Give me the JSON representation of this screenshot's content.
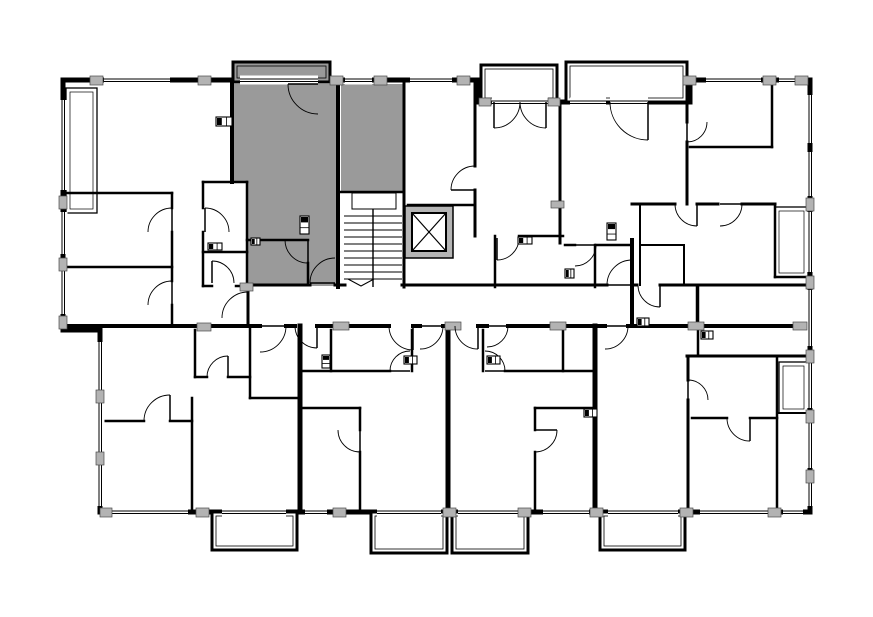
{
  "meta": {
    "title": "apartment-building-floor-plan",
    "canvas": {
      "w": 873,
      "h": 617
    }
  },
  "colors": {
    "bg": "#ffffff",
    "wall": "#000000",
    "highlight": "#9a9a9a",
    "pier": "#b3b3b3",
    "pier_edge": "#4a4a4a",
    "elevator_wall": "#b5b5b5",
    "thin_line": "#000000"
  },
  "plan": {
    "outline": [
      [
        63,
        80
      ],
      [
        477,
        80
      ],
      [
        477,
        102
      ],
      [
        690,
        102
      ],
      [
        690,
        80
      ],
      [
        810,
        80
      ],
      [
        810,
        512
      ],
      [
        100,
        512
      ],
      [
        100,
        330
      ],
      [
        63,
        330
      ]
    ],
    "balconies": [
      {
        "x": 233,
        "y": 62,
        "w": 97,
        "h": 20,
        "fill": "highlight"
      },
      {
        "x": 481,
        "y": 65,
        "w": 76,
        "h": 37,
        "fill": "bg"
      },
      {
        "x": 566,
        "y": 62,
        "w": 121,
        "h": 40,
        "fill": "bg"
      },
      {
        "x": 212,
        "y": 512,
        "w": 85,
        "h": 38,
        "fill": "bg"
      },
      {
        "x": 371,
        "y": 512,
        "w": 76,
        "h": 41,
        "fill": "bg"
      },
      {
        "x": 452,
        "y": 512,
        "w": 76,
        "h": 41,
        "fill": "bg"
      },
      {
        "x": 600,
        "y": 512,
        "w": 85,
        "h": 38,
        "fill": "bg"
      }
    ],
    "highlight_polys": [
      [
        [
          232,
          84
        ],
        [
          338,
          84
        ],
        [
          338,
          286
        ],
        [
          247,
          286
        ],
        [
          247,
          182
        ],
        [
          232,
          182
        ]
      ],
      [
        [
          341,
          84
        ],
        [
          403,
          84
        ],
        [
          403,
          192
        ],
        [
          341,
          192
        ]
      ]
    ],
    "thin_rooms": [
      {
        "x": 66,
        "y": 88,
        "w": 31,
        "h": 125
      },
      {
        "x": 775,
        "y": 207,
        "w": 33,
        "h": 70
      },
      {
        "x": 779,
        "y": 362,
        "w": 29,
        "h": 51
      }
    ],
    "walls": [
      [
        232,
        84,
        232,
        182,
        4
      ],
      [
        338,
        84,
        338,
        287,
        4
      ],
      [
        404,
        84,
        404,
        287,
        3
      ],
      [
        475,
        80,
        475,
        166,
        3
      ],
      [
        475,
        190,
        475,
        236,
        3
      ],
      [
        560,
        102,
        560,
        243,
        3
      ],
      [
        632,
        240,
        632,
        326,
        4
      ],
      [
        687,
        80,
        687,
        122,
        3
      ],
      [
        687,
        142,
        687,
        204,
        3
      ],
      [
        772,
        80,
        772,
        147,
        2.5
      ],
      [
        248,
        285,
        310,
        285,
        3
      ],
      [
        335,
        285,
        345,
        285,
        3
      ],
      [
        402,
        285,
        607,
        285,
        3
      ],
      [
        632,
        285,
        637,
        285,
        3
      ],
      [
        660,
        285,
        810,
        285,
        3
      ],
      [
        248,
        285,
        248,
        326,
        3
      ],
      [
        63,
        326,
        260,
        326,
        4
      ],
      [
        286,
        326,
        295,
        326,
        4
      ],
      [
        317,
        326,
        389,
        326,
        4
      ],
      [
        413,
        326,
        420,
        326,
        4
      ],
      [
        443,
        326,
        455,
        326,
        4
      ],
      [
        478,
        326,
        487,
        326,
        4
      ],
      [
        508,
        326,
        605,
        326,
        4
      ],
      [
        628,
        326,
        810,
        326,
        4
      ],
      [
        247,
        240,
        308,
        240,
        2.5
      ],
      [
        308,
        263,
        308,
        285,
        2.5
      ],
      [
        341,
        192,
        403,
        192,
        2.5
      ],
      [
        203,
        182,
        247,
        182,
        2.5
      ],
      [
        203,
        182,
        203,
        208,
        2.5
      ],
      [
        203,
        232,
        203,
        286,
        2.5
      ],
      [
        247,
        182,
        247,
        287,
        2.5
      ],
      [
        203,
        252,
        247,
        252,
        2.5
      ],
      [
        203,
        286,
        212,
        286,
        2.5
      ],
      [
        236,
        286,
        247,
        286,
        2.5
      ],
      [
        63,
        193,
        172,
        193,
        2.5
      ],
      [
        172,
        193,
        172,
        208,
        2.5
      ],
      [
        172,
        232,
        172,
        281,
        2.5
      ],
      [
        172,
        305,
        172,
        326,
        2.5
      ],
      [
        63,
        267,
        172,
        267,
        2.5
      ],
      [
        408,
        205,
        475,
        205,
        2.5
      ],
      [
        519,
        236,
        563,
        236,
        2.5
      ],
      [
        495,
        236,
        495,
        287,
        2.5
      ],
      [
        565,
        245,
        575,
        245,
        2.5
      ],
      [
        596,
        245,
        632,
        245,
        2.5
      ],
      [
        595,
        245,
        595,
        287,
        2.5
      ],
      [
        690,
        147,
        772,
        147,
        2.5
      ],
      [
        632,
        204,
        675,
        204,
        3
      ],
      [
        697,
        204,
        718,
        204,
        3
      ],
      [
        742,
        204,
        775,
        204,
        3
      ],
      [
        775,
        204,
        775,
        277,
        2.5
      ],
      [
        775,
        277,
        810,
        277,
        2.5
      ],
      [
        698,
        287,
        698,
        356,
        2.5
      ],
      [
        640,
        204,
        640,
        285,
        2
      ],
      [
        684,
        245,
        684,
        285,
        2
      ],
      [
        640,
        245,
        684,
        245,
        2
      ],
      [
        697,
        287,
        697,
        326,
        2.5
      ],
      [
        687,
        356,
        810,
        356,
        3
      ],
      [
        688,
        356,
        688,
        380,
        3
      ],
      [
        688,
        400,
        688,
        512,
        3
      ],
      [
        692,
        418,
        727,
        418,
        2.5
      ],
      [
        750,
        418,
        777,
        418,
        2.5
      ],
      [
        777,
        356,
        777,
        512,
        2.5
      ],
      [
        777,
        413,
        808,
        413,
        2
      ],
      [
        195,
        330,
        195,
        377,
        2.5
      ],
      [
        195,
        377,
        207,
        377,
        2.5
      ],
      [
        228,
        377,
        250,
        377,
        2.5
      ],
      [
        250,
        326,
        250,
        398,
        2.5
      ],
      [
        250,
        398,
        297,
        398,
        2.5
      ],
      [
        97,
        421,
        144,
        421,
        2.5
      ],
      [
        170,
        421,
        192,
        421,
        2.5
      ],
      [
        192,
        398,
        192,
        512,
        2.5
      ],
      [
        300,
        326,
        300,
        512,
        5
      ],
      [
        448,
        326,
        448,
        512,
        5
      ],
      [
        595,
        326,
        595,
        512,
        5
      ],
      [
        331,
        330,
        331,
        371,
        2.5
      ],
      [
        303,
        371,
        390,
        371,
        2.5
      ],
      [
        412,
        330,
        412,
        371,
        2.5
      ],
      [
        303,
        408,
        360,
        408,
        2.5
      ],
      [
        360,
        408,
        360,
        430,
        2.5
      ],
      [
        360,
        452,
        360,
        512,
        2.5
      ],
      [
        483,
        330,
        483,
        371,
        2.5
      ],
      [
        505,
        371,
        595,
        371,
        2.5
      ],
      [
        563,
        330,
        563,
        371,
        2.5
      ],
      [
        535,
        408,
        595,
        408,
        2.5
      ],
      [
        535,
        408,
        535,
        430,
        2.5
      ],
      [
        535,
        452,
        535,
        512,
        2.5
      ]
    ],
    "windows": [
      {
        "o": "h",
        "x": 104,
        "y": 80,
        "len": 66
      },
      {
        "o": "h",
        "x": 240,
        "y": 80,
        "len": 78
      },
      {
        "o": "h",
        "x": 345,
        "y": 80,
        "len": 27
      },
      {
        "o": "h",
        "x": 410,
        "y": 80,
        "len": 42
      },
      {
        "o": "h",
        "x": 492,
        "y": 102,
        "len": 56
      },
      {
        "o": "h",
        "x": 570,
        "y": 102,
        "len": 36
      },
      {
        "o": "h",
        "x": 610,
        "y": 102,
        "len": 38
      },
      {
        "o": "h",
        "x": 706,
        "y": 80,
        "len": 55
      },
      {
        "o": "h",
        "x": 779,
        "y": 80,
        "len": 16
      },
      {
        "o": "h",
        "x": 112,
        "y": 512,
        "len": 76
      },
      {
        "o": "h",
        "x": 222,
        "y": 512,
        "len": 64
      },
      {
        "o": "h",
        "x": 305,
        "y": 512,
        "len": 22
      },
      {
        "o": "h",
        "x": 377,
        "y": 512,
        "len": 64
      },
      {
        "o": "h",
        "x": 458,
        "y": 512,
        "len": 64
      },
      {
        "o": "h",
        "x": 543,
        "y": 512,
        "len": 46
      },
      {
        "o": "h",
        "x": 608,
        "y": 512,
        "len": 70
      },
      {
        "o": "h",
        "x": 700,
        "y": 512,
        "len": 68
      },
      {
        "o": "h",
        "x": 783,
        "y": 512,
        "len": 20
      },
      {
        "o": "v",
        "x": 63,
        "y": 100,
        "len": 90
      },
      {
        "o": "v",
        "x": 63,
        "y": 212,
        "len": 42
      },
      {
        "o": "v",
        "x": 63,
        "y": 270,
        "len": 44
      },
      {
        "o": "v",
        "x": 100,
        "y": 342,
        "len": 48
      },
      {
        "o": "v",
        "x": 100,
        "y": 402,
        "len": 50
      },
      {
        "o": "v",
        "x": 100,
        "y": 464,
        "len": 42
      },
      {
        "o": "v",
        "x": 810,
        "y": 95,
        "len": 48
      },
      {
        "o": "v",
        "x": 810,
        "y": 152,
        "len": 44
      },
      {
        "o": "v",
        "x": 810,
        "y": 212,
        "len": 60
      },
      {
        "o": "v",
        "x": 810,
        "y": 290,
        "len": 56
      },
      {
        "o": "v",
        "x": 810,
        "y": 362,
        "len": 46
      },
      {
        "o": "v",
        "x": 810,
        "y": 420,
        "len": 48
      },
      {
        "o": "v",
        "x": 810,
        "y": 478,
        "len": 28
      }
    ],
    "piers": [
      [
        90,
        76,
        13,
        9
      ],
      [
        198,
        76,
        13,
        9
      ],
      [
        330,
        76,
        13,
        9
      ],
      [
        374,
        76,
        13,
        9
      ],
      [
        457,
        76,
        13,
        9
      ],
      [
        683,
        76,
        13,
        9
      ],
      [
        763,
        76,
        13,
        9
      ],
      [
        795,
        76,
        13,
        9
      ],
      [
        479,
        98,
        12,
        8
      ],
      [
        548,
        98,
        12,
        8
      ],
      [
        100,
        508,
        12,
        9
      ],
      [
        196,
        508,
        13,
        9
      ],
      [
        333,
        508,
        13,
        9
      ],
      [
        443,
        508,
        13,
        9
      ],
      [
        518,
        508,
        13,
        9
      ],
      [
        590,
        508,
        13,
        9
      ],
      [
        680,
        508,
        13,
        9
      ],
      [
        768,
        508,
        13,
        9
      ],
      [
        333,
        322,
        16,
        8
      ],
      [
        445,
        322,
        16,
        8
      ],
      [
        550,
        322,
        16,
        8
      ],
      [
        688,
        322,
        16,
        8
      ],
      [
        793,
        322,
        14,
        8
      ],
      [
        240,
        283,
        13,
        8
      ],
      [
        197,
        323,
        14,
        8
      ],
      [
        551,
        201,
        13,
        7
      ],
      [
        59,
        196,
        8,
        13
      ],
      [
        59,
        258,
        8,
        13
      ],
      [
        59,
        316,
        8,
        13
      ],
      [
        96,
        390,
        8,
        13
      ],
      [
        96,
        452,
        8,
        13
      ],
      [
        806,
        198,
        8,
        13
      ],
      [
        806,
        276,
        8,
        13
      ],
      [
        806,
        350,
        8,
        13
      ],
      [
        806,
        410,
        8,
        13
      ],
      [
        806,
        470,
        8,
        13
      ]
    ],
    "doors": [
      [
        318,
        84,
        30,
        180,
        90
      ],
      [
        308,
        240,
        23,
        90,
        180
      ],
      [
        335,
        283,
        25,
        180,
        270
      ],
      [
        248,
        318,
        26,
        270,
        180
      ],
      [
        475,
        190,
        24,
        180,
        270
      ],
      [
        494,
        102,
        26,
        90,
        0
      ],
      [
        546,
        102,
        26,
        90,
        180
      ],
      [
        648,
        102,
        38,
        90,
        180
      ],
      [
        497,
        238,
        22,
        90,
        0
      ],
      [
        575,
        245,
        21,
        0,
        90
      ],
      [
        697,
        204,
        22,
        90,
        180
      ],
      [
        687,
        122,
        20,
        90,
        0
      ],
      [
        720,
        204,
        22,
        0,
        90
      ],
      [
        260,
        326,
        26,
        0,
        90
      ],
      [
        317,
        326,
        22,
        90,
        180
      ],
      [
        413,
        326,
        24,
        90,
        180
      ],
      [
        420,
        326,
        23,
        0,
        90
      ],
      [
        478,
        326,
        23,
        90,
        180
      ],
      [
        487,
        326,
        21,
        0,
        90
      ],
      [
        632,
        285,
        25,
        180,
        270
      ],
      [
        660,
        285,
        22,
        90,
        180
      ],
      [
        360,
        430,
        22,
        90,
        180
      ],
      [
        535,
        430,
        22,
        0,
        90
      ],
      [
        605,
        326,
        23,
        0,
        90
      ],
      [
        750,
        418,
        23,
        90,
        180
      ],
      [
        688,
        400,
        20,
        270,
        0
      ],
      [
        170,
        421,
        26,
        270,
        180
      ],
      [
        228,
        377,
        21,
        270,
        180
      ],
      [
        172,
        232,
        24,
        270,
        180
      ],
      [
        172,
        305,
        24,
        270,
        180
      ],
      [
        205,
        232,
        24,
        270,
        0
      ],
      [
        212,
        283,
        22,
        270,
        0
      ],
      [
        410,
        371,
        20,
        180,
        270
      ],
      [
        485,
        371,
        20,
        0,
        270
      ]
    ],
    "fixtures": [
      [
        216,
        117,
        16,
        9
      ],
      [
        300,
        216,
        9,
        18
      ],
      [
        208,
        243,
        14,
        7
      ],
      [
        251,
        238,
        9,
        7
      ],
      [
        518,
        237,
        14,
        7
      ],
      [
        607,
        223,
        9,
        17
      ],
      [
        565,
        269,
        9,
        9
      ],
      [
        404,
        356,
        13,
        8
      ],
      [
        487,
        356,
        13,
        8
      ],
      [
        322,
        355,
        8,
        13
      ],
      [
        637,
        318,
        12,
        8
      ],
      [
        701,
        331,
        12,
        8
      ],
      [
        584,
        409,
        13,
        8
      ]
    ],
    "stairs": {
      "x": 344,
      "y": 209,
      "w": 58,
      "h": 78,
      "tread_start": 216,
      "tread_step": 7,
      "tread_count": 10,
      "divider_x": 373,
      "landing": {
        "x": 352,
        "y": 193,
        "w": 44,
        "h": 16
      },
      "arrow": [
        [
          348,
          279
        ],
        [
          361,
          286
        ],
        [
          374,
          279
        ]
      ]
    },
    "elevator": {
      "x": 405,
      "y": 206,
      "w": 48,
      "h": 52,
      "inset": 7
    }
  }
}
